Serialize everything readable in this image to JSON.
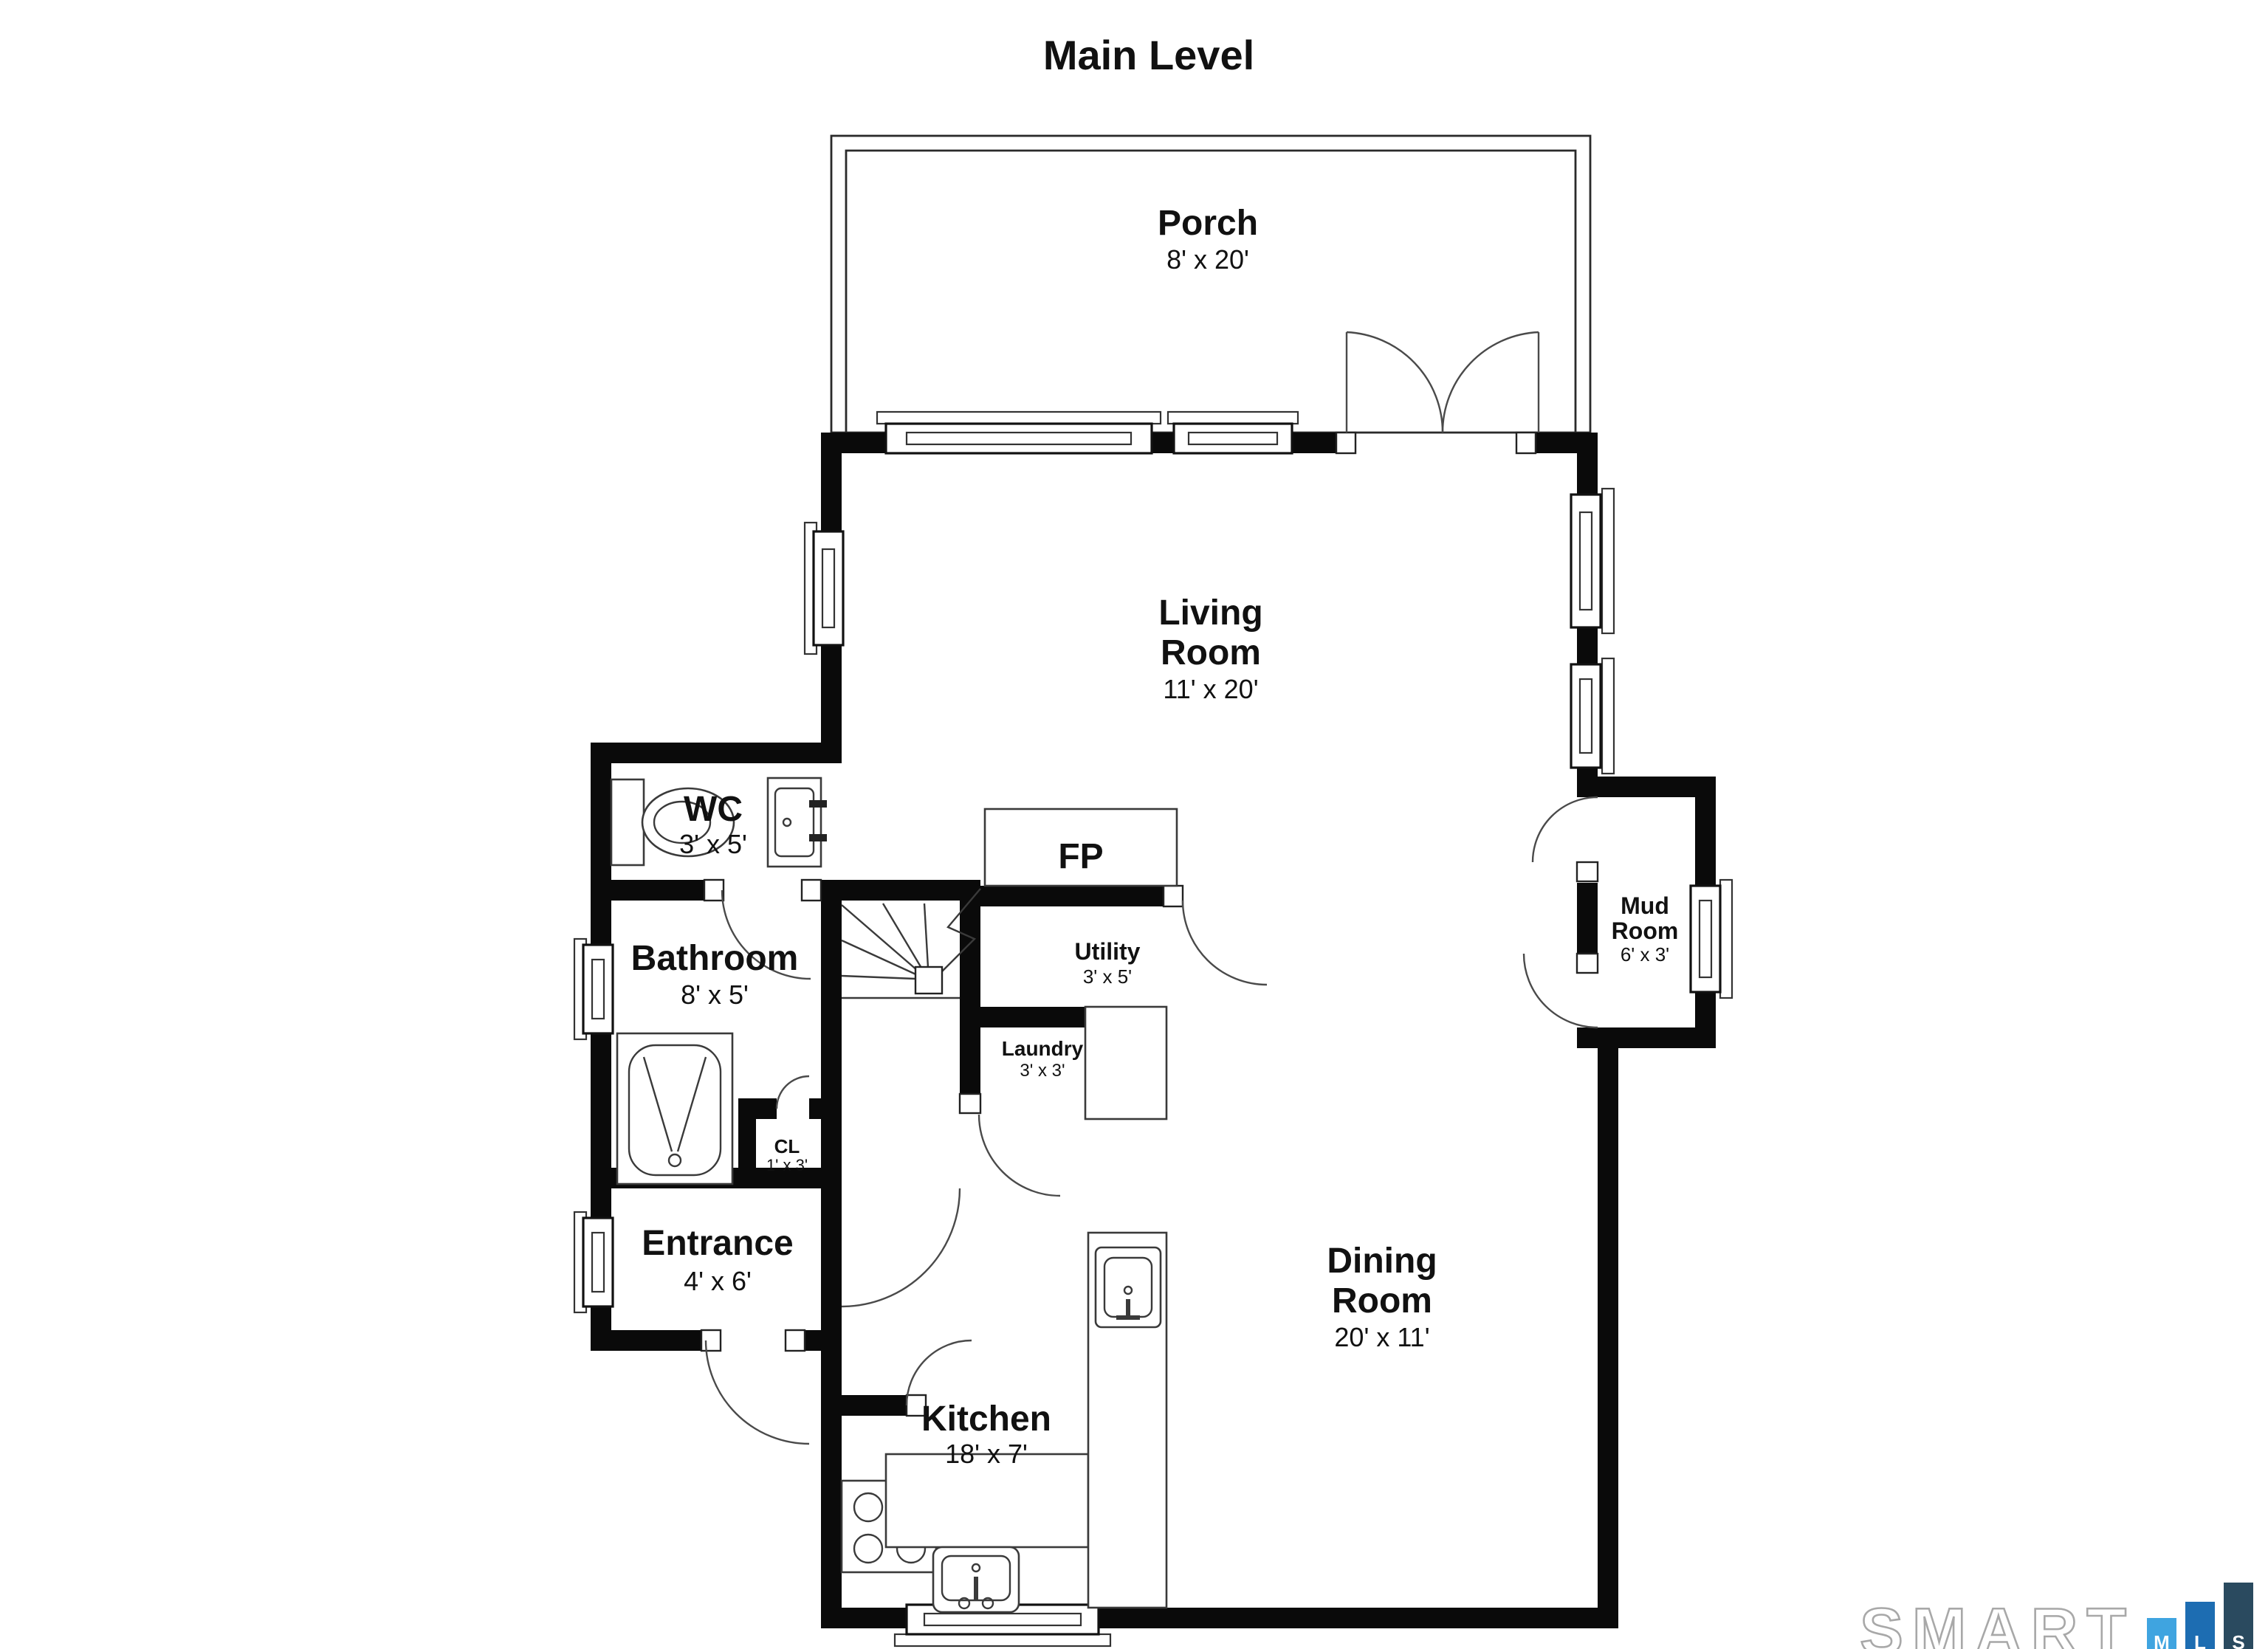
{
  "title": "Main Level",
  "rooms": {
    "porch": {
      "name": "Porch",
      "dims": "8' x 20'"
    },
    "living_room": {
      "line1": "Living",
      "line2": "Room",
      "dims": "11' x 20'"
    },
    "wc": {
      "name": "WC",
      "dims": "3' x 5'"
    },
    "fireplace": {
      "name": "FP"
    },
    "utility": {
      "name": "Utility",
      "dims": "3' x 5'"
    },
    "bathroom": {
      "name": "Bathroom",
      "dims": "8' x 5'"
    },
    "laundry": {
      "name": "Laundry",
      "dims": "3' x 3'"
    },
    "closet": {
      "name": "CL",
      "dims": "1' x 3'"
    },
    "mud_room": {
      "line1": "Mud",
      "line2": "Room",
      "dims": "6' x 3'"
    },
    "entrance": {
      "name": "Entrance",
      "dims": "4' x 6'"
    },
    "kitchen": {
      "name": "Kitchen",
      "dims": "18' x 7'"
    },
    "dining_room": {
      "line1": "Dining",
      "line2": "Room",
      "dims": "20' x 11'"
    }
  },
  "branding": {
    "logo_text": "SMART",
    "outline_color": "#a8a8a8",
    "bars": [
      {
        "letter": "M",
        "color": "#3fa4e0"
      },
      {
        "letter": "L",
        "color": "#1d6db2"
      },
      {
        "letter": "S",
        "color": "#2a4a5f"
      }
    ]
  }
}
